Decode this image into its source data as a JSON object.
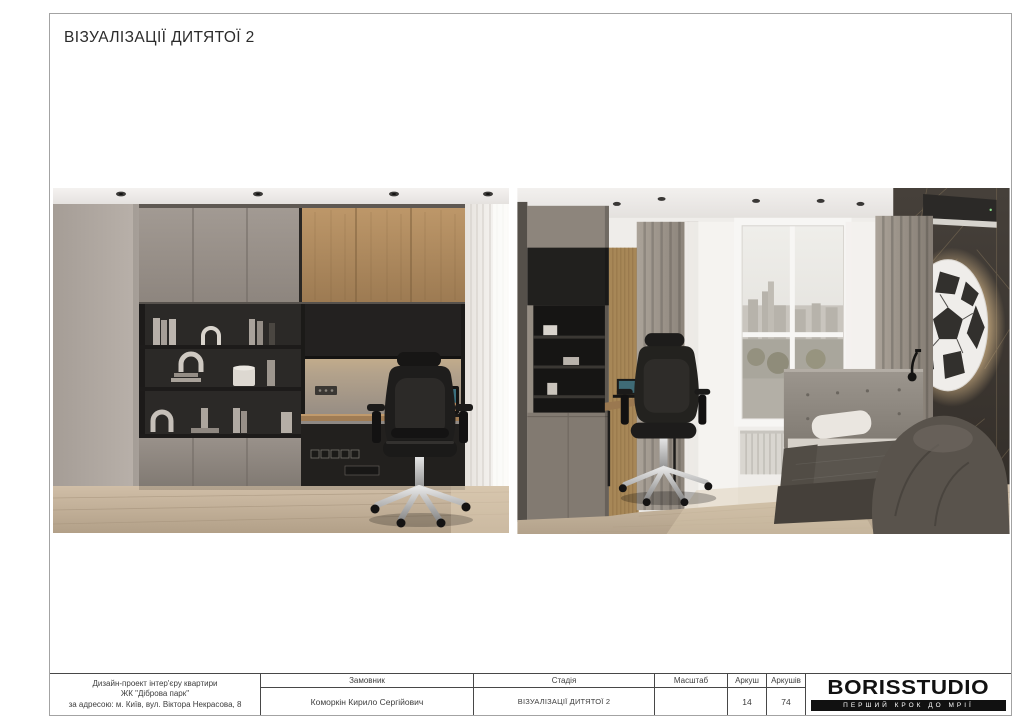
{
  "page": {
    "title": "ВІЗУАЛІЗАЦІЇ ДИТЯТОЇ 2",
    "background_color": "#ffffff",
    "frame_border_color": "#a3a3a3"
  },
  "title_block": {
    "border_color": "#474747",
    "project_info": {
      "line1": "Дизайн-проект інтер'єру квартири",
      "line2": "ЖК \"Діброва парк\"",
      "line3": "за адресою: м. Київ, вул. Віктора Некрасова, 8"
    },
    "client": {
      "label": "Замовник",
      "value": "Коморкін Кирило Сергійович"
    },
    "stage": {
      "label": "Стадія",
      "value": "ВІЗУАЛІЗАЦІЇ ДИТЯТОЇ 2"
    },
    "scale": {
      "label": "Масштаб",
      "value": ""
    },
    "sheet": {
      "label": "Аркуш",
      "value": "14"
    },
    "sheets_total": {
      "label": "Аркушів",
      "value": "74"
    },
    "logo": {
      "text": "BORISSTUDIO",
      "tagline": "ПЕРШИЙ КРОК ДО МРІЇ",
      "text_color": "#111111",
      "tagline_bar_color": "#111111",
      "tagline_text_color": "#ffffff"
    }
  },
  "renders": {
    "palette": {
      "wall_gray": "#b3aaa3",
      "cabinet_gray": "#968e87",
      "cabinet_wood": "#b08c60",
      "shelf_black": "#282624",
      "floor_wood": "#c8b69e",
      "accent_wall": "#3a3530",
      "curtain_white": "#f4f2ef",
      "led_glow": "#ecc994"
    }
  }
}
